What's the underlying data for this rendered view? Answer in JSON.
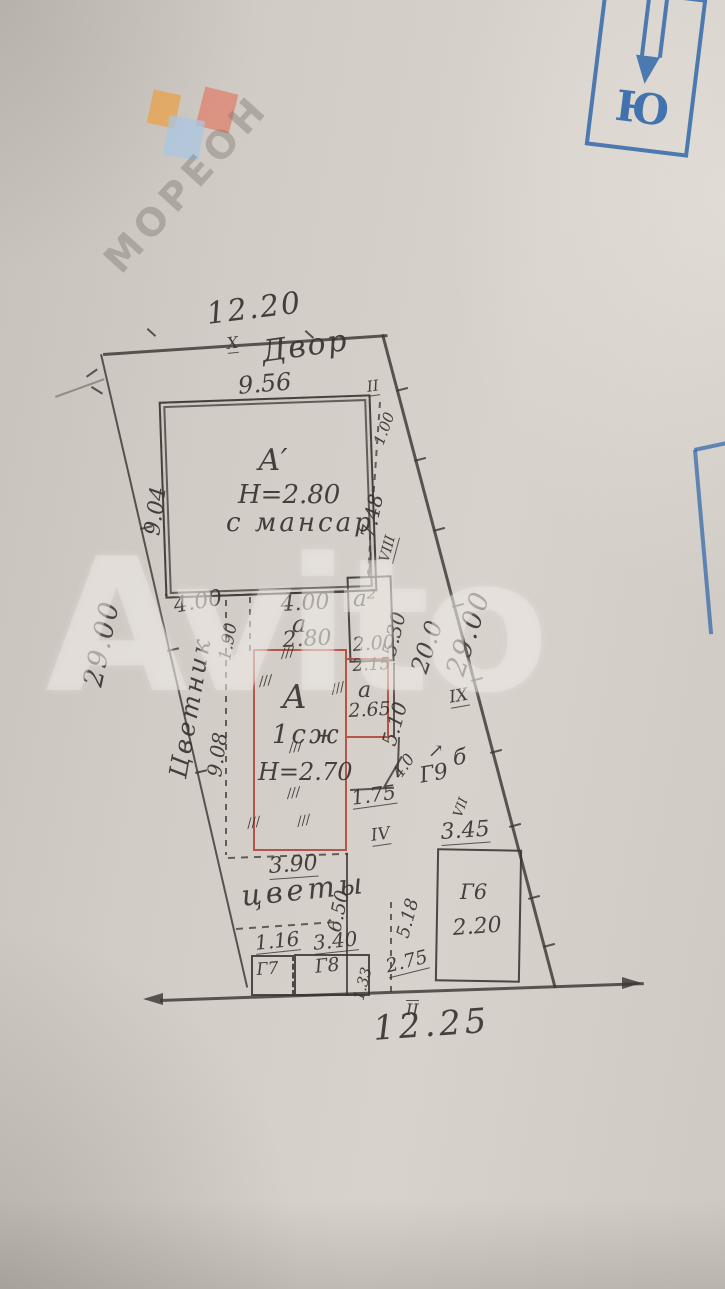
{
  "labels": {
    "yard": "Двор",
    "flower_bed": "Цветник",
    "flowers": "цветы",
    "hatch": "///"
  },
  "house": {
    "name": "А′",
    "h": "Н=2.80",
    "mansard": "с мансар"
  },
  "main_house": {
    "name": "А",
    "floor": "1сж",
    "h": "Н=2.70"
  },
  "annex2": {
    "name": "а²"
  },
  "annex_a": {
    "name": "а"
  },
  "passage": {
    "name": "а"
  },
  "sheds": {
    "g6": "Г6",
    "g7": "Г7",
    "g8": "Г8",
    "g9": "Г9",
    "b": "б"
  },
  "dims": {
    "d1220": "12.20",
    "d956": "9.56",
    "d904": "9.04",
    "d2900l": "29.00",
    "d2900r": "29.00",
    "d200r": "20.0",
    "d400l": "4.00",
    "d400c": "4.00",
    "d280": "2.80",
    "d190": "1.90",
    "d908": "9.08",
    "d100": "1.00",
    "d748": "7.48",
    "d530": "5.30",
    "d200b": "2.00",
    "d215": "2.15",
    "d265": "2.65",
    "d510": "5.10",
    "d175": "1.75",
    "d40": "4.0",
    "d390": "3.90",
    "d650": "6.50",
    "d345": "3.45",
    "d220": "2.20",
    "d518": "5.18",
    "d116": "1.16",
    "d340": "3.40",
    "d133": "1.33",
    "d275": "2.75",
    "d1225": "12.25"
  },
  "points": {
    "x_top": "Х",
    "ii_top": "II",
    "viii": "VIII",
    "ix": "IX",
    "vii": "VII",
    "vi_arrow": "↗",
    "iv": "IV",
    "ii_bottom": "II"
  },
  "stamp": {
    "south": "Ю"
  },
  "watermarks": {
    "moreon": "МОРЕОН",
    "avito": "Avito"
  },
  "colors": {
    "pencil": "#3c3732",
    "red_outline": "#b2493e",
    "stamp_blue": "#2b64a8"
  }
}
